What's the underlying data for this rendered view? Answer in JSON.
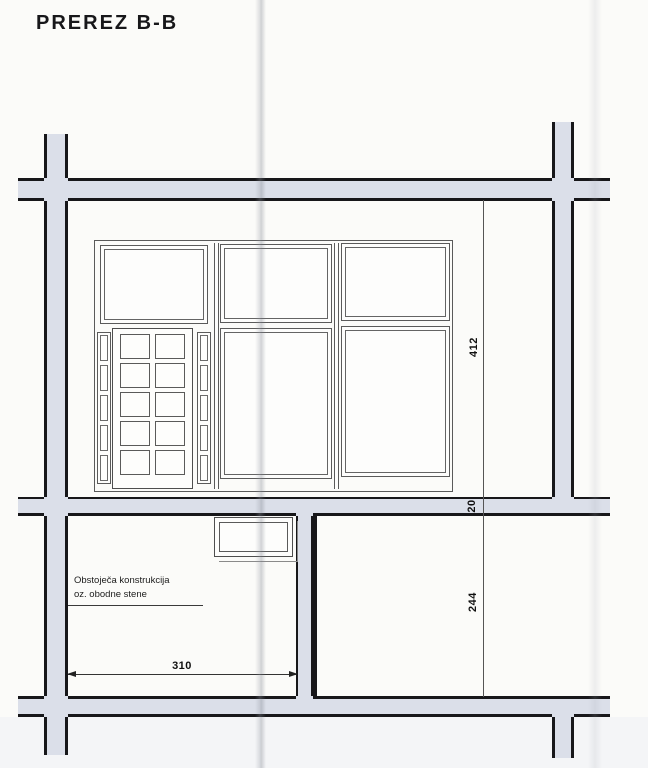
{
  "title": "PREREZ B-B",
  "note": {
    "line1": "Obstoječa konstrukcija",
    "line2": "oz. obodne stene"
  },
  "dimensions": {
    "window_zone_height": "412",
    "wall_thickness": "20",
    "lower_zone_height": "244",
    "room_width": "310"
  },
  "colors": {
    "paper": "#fbfbf9",
    "wall_fill": "#dbdfe9",
    "wall_edge": "#17171a",
    "drawing_line": "#5a5a5a",
    "text": "#101010"
  }
}
